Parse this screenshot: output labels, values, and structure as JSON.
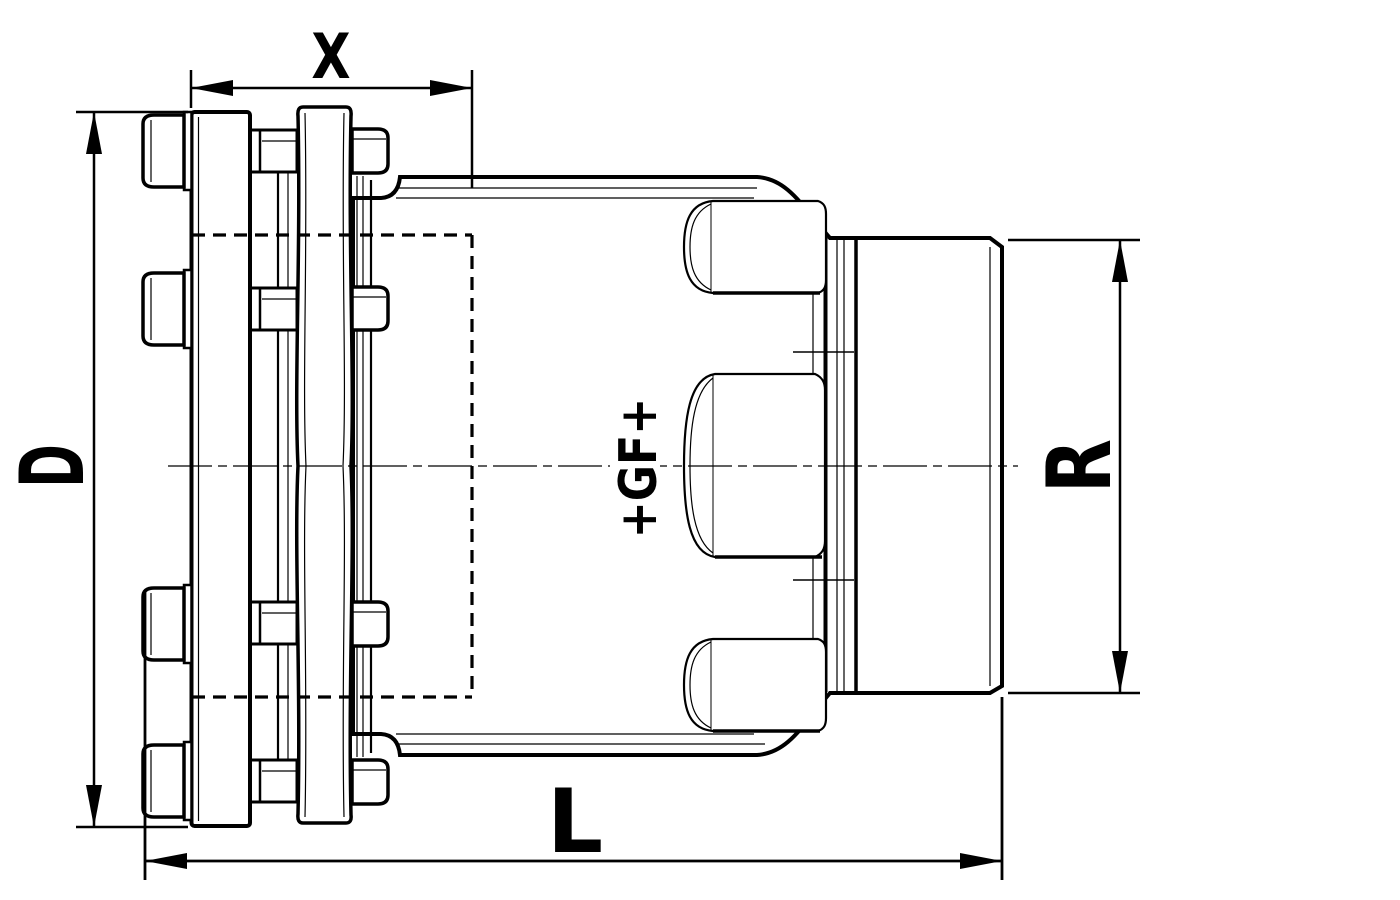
{
  "document": {
    "kind": "technical drawing",
    "background_color": "#ffffff",
    "line_color": "#000000"
  },
  "dimensions": {
    "top_label": "X",
    "left_label": "D",
    "right_label": "R",
    "bottom_label": "L"
  },
  "logo": {
    "text": "+GF+"
  }
}
